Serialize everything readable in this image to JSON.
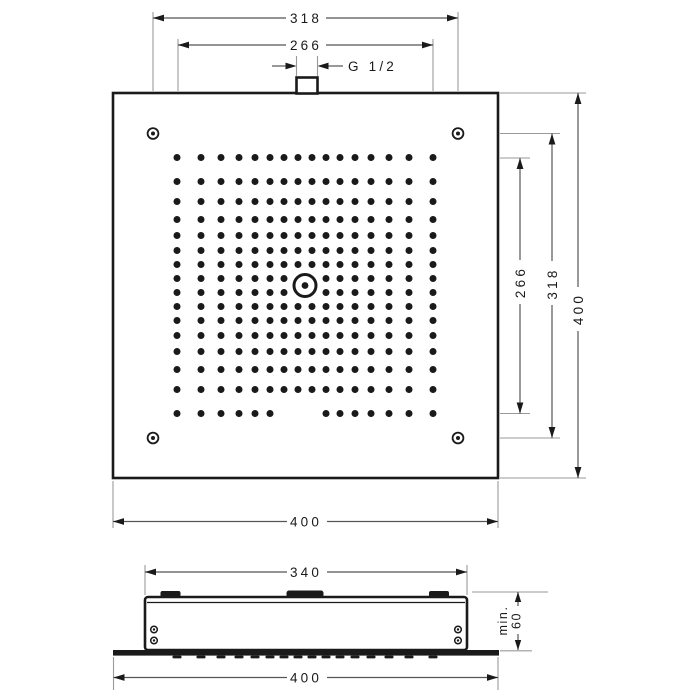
{
  "drawing": {
    "product_type": "overhead-shower-ceiling-mounted",
    "views": [
      "top-view",
      "side-view"
    ]
  },
  "top_view": {
    "dim_screw_spacing_top": "318",
    "dim_nozzle_field_top": "266",
    "thread_label": "G 1/2",
    "dim_nozzle_field_right": "266",
    "dim_screw_spacing_right": "318",
    "dim_overall_right": "400",
    "dim_overall_bottom": "400"
  },
  "side_view": {
    "dim_body_width": "340",
    "dim_overall_width": "400",
    "dim_min_depth_prefix": "min.",
    "dim_min_depth_value": "60"
  },
  "nozzle_pattern": {
    "center_x": 305,
    "center_y": 285.5,
    "offsets": [
      7,
      21,
      35,
      50,
      66,
      84,
      104,
      128
    ],
    "dot_radius": 3.5,
    "center_clear_radius": 11,
    "bottom_row_missing_offsets": [
      -21,
      -7,
      7
    ],
    "side_dash_y": 655.6,
    "side_dash_w": 9,
    "side_dash_h": 2.8
  },
  "colors": {
    "line": "#1a1a1a",
    "dim_line": "#555555",
    "ext_line": "#9a9a9a",
    "text": "#1a1a1a",
    "background": "#ffffff"
  }
}
